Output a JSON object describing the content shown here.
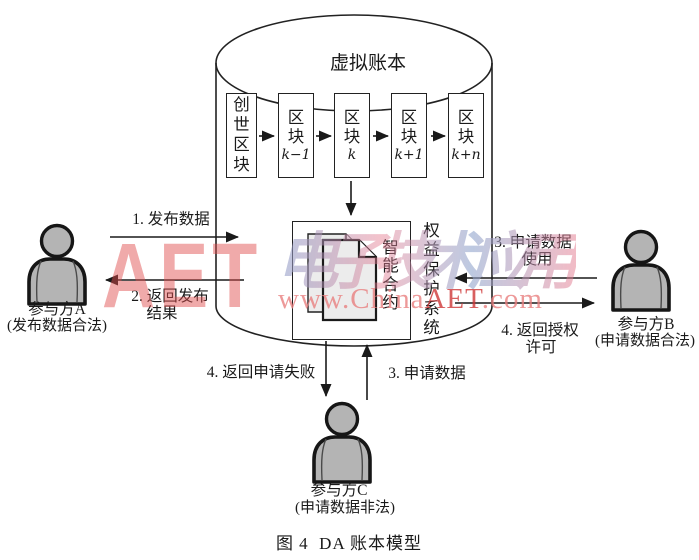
{
  "figure": {
    "caption": "图 4  DA 账本模型"
  },
  "ledger": {
    "title": "虚拟账本",
    "blocks": [
      {
        "label": "创世区块",
        "sub": ""
      },
      {
        "label": "区块",
        "sub": "k−1"
      },
      {
        "label": "区块",
        "sub": "k"
      },
      {
        "label": "区块",
        "sub": "k+1"
      },
      {
        "label": "区块",
        "sub": "k+n"
      }
    ],
    "contract_label": "智能合约",
    "system_label": "权益保护系统"
  },
  "participants": [
    {
      "name": "参与方A",
      "note": "(发布数据合法)"
    },
    {
      "name": "参与方B",
      "note": "(申请数据合法)"
    },
    {
      "name": "参与方C",
      "note": "(申请数据非法)"
    }
  ],
  "flows": {
    "publish": "1. 发布数据",
    "publish_result_l1": "2. 返回发布",
    "publish_result_l2": "结果",
    "request_use_l1": "3. 申请数据",
    "request_use_l2": "使用",
    "grant_l1": "4. 返回授权",
    "grant_l2": "许可",
    "request_fail": "4. 返回申请失败",
    "request": "3. 申请数据"
  },
  "watermark": {
    "aet": "AET",
    "brand": "电子技术应用",
    "url_pre": "www.China",
    "url_mid": "AET",
    "url_post": ".com"
  },
  "colors": {
    "line": "#1a1a1a",
    "person_fill": "#b4b4b4",
    "doc_fill": "#ececec",
    "watermark_pink": "#f2a9a9",
    "watermark_red": "#ce3737",
    "watermark_blue": "#8ca0cd"
  }
}
